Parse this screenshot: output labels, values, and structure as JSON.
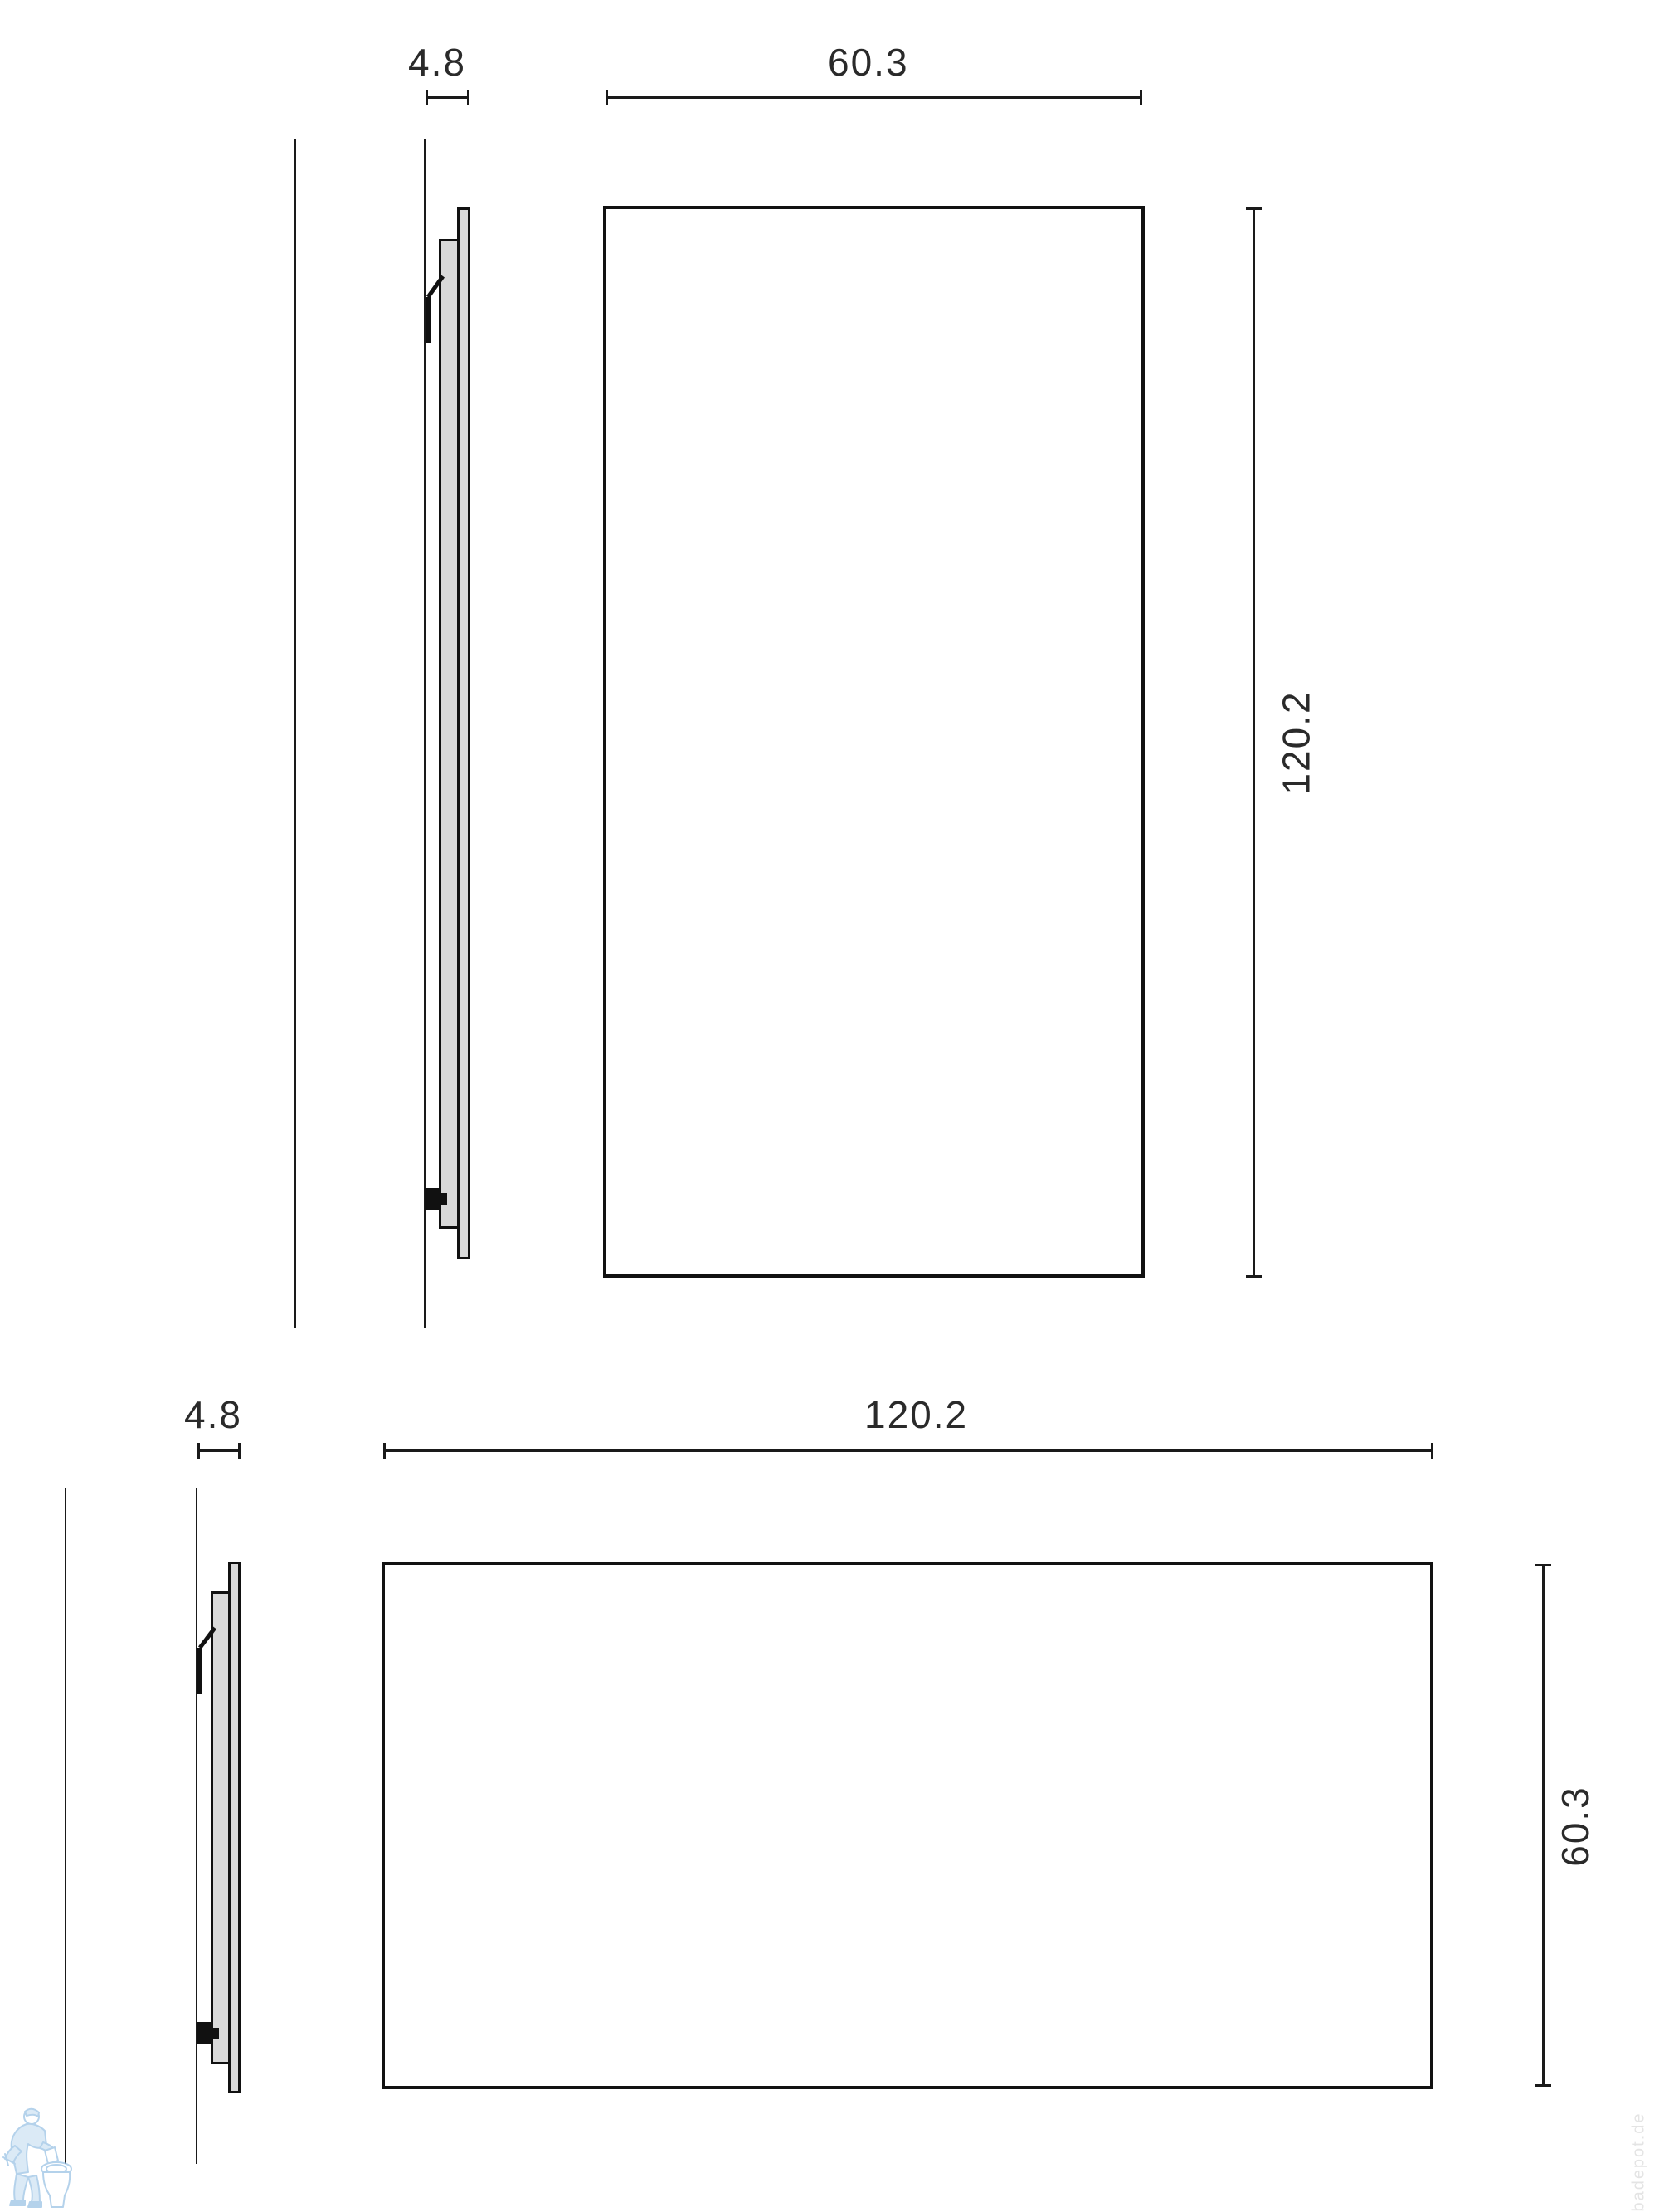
{
  "drawing": {
    "title": "wall panel dimension drawing, side profile and front view, two orientations",
    "views": [
      {
        "id": "portrait",
        "thickness": "4.8",
        "width": "60.3",
        "height": "120.2"
      },
      {
        "id": "landscape",
        "thickness": "4.8",
        "width": "120.2",
        "height": "60.3"
      }
    ]
  },
  "labels": {
    "top_thickness": "4.8",
    "top_width": "60.3",
    "top_height": "120.2",
    "bottom_thickness": "4.8",
    "bottom_width": "120.2",
    "bottom_height": "60.3"
  },
  "colors": {
    "line": "#1a1a1a",
    "panel_fill": "#d9d9d9",
    "background": "#ffffff",
    "watermark_blue": "#aecfe8",
    "watermark_gray": "#e4e4e4"
  },
  "watermark": {
    "mascot": "plumber-with-toilet",
    "vertical_text": "badepot.de"
  }
}
